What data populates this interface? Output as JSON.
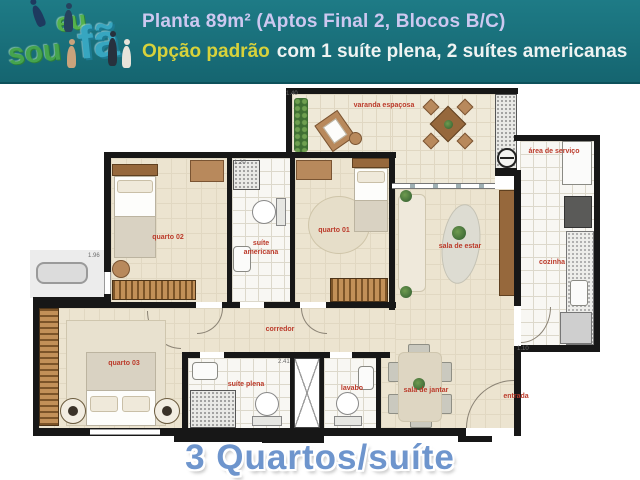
{
  "header": {
    "logo": {
      "eu": "eu",
      "sou": "sou",
      "fa": "fã"
    },
    "title_line1": "Planta 89m² (Aptos Final 2, Blocos B/C)",
    "title_line2_highlight": "Opção padrão",
    "title_line2_rest": "com 1 suíte plena, 2 suítes americanas"
  },
  "floorplan": {
    "rooms": {
      "varanda": "varanda espaçosa",
      "quarto02": "quarto 02",
      "suite_americana": "suíte americana",
      "quarto01": "quarto 01",
      "sala_estar": "sala de estar",
      "area_servico": "área de serviço",
      "cozinha": "cozinha",
      "corredor": "corredor",
      "quarto03": "quarto 03",
      "suite_plena": "suíte plena",
      "lavabo": "lavabo",
      "sala_jantar": "sala de jantar",
      "entrada": "entrada"
    },
    "dimensions": [
      "1.40",
      "1.20",
      "1.96",
      "2.41",
      "1.10"
    ]
  },
  "caption": "3 Quartos/suíte",
  "colors": {
    "header_teal": "#166d79",
    "accent_yellow": "#d7d23b",
    "title_lavender": "#cdc8f0",
    "label_red": "#bb3a2a",
    "caption_blue": "#6e95cd"
  }
}
